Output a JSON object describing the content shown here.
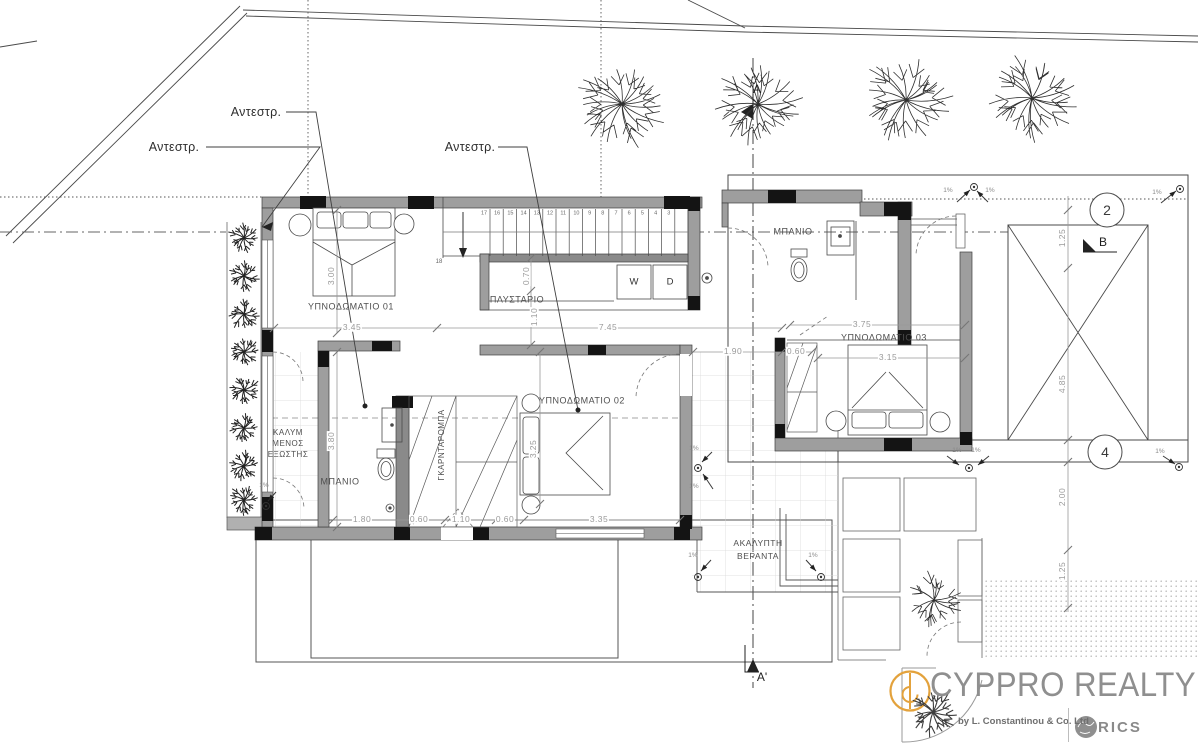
{
  "plan": {
    "rooms": {
      "bedroom01": "ΥΠΝΟΔΩΜΑΤΙΟ 01",
      "bedroom02": "ΥΠΝΟΔΩΜΑΤΙΟ 02",
      "bedroom03": "ΥΠΝΟΔΩΜΑΤΙΟ 03",
      "laundry": "ΠΛΥΣΤΑΡΙΟ",
      "bath_top": "ΜΠΑΝΙΟ",
      "bath_left": "ΜΠΑΝΙΟ",
      "wardrobe": "ΓΚΑΡΝΤΑΡΟΜΠΑ",
      "covered_balcony_lines": [
        "ΚΑΛΥΜ",
        "ΜΕΝΟΣ",
        "ΕΞΩΣΤΗΣ"
      ],
      "veranda_lines": [
        "ΑΚΑΛΥΠΤΗ",
        "ΒΕΡΑΝΤΑ"
      ]
    },
    "annotations": {
      "inverted": "Αντεστρ.",
      "slope": "1%",
      "riser18": "18",
      "washer": "W",
      "dryer": "D"
    },
    "markers": {
      "section_a": "A",
      "section_a_prime": "A'",
      "section_b": "B",
      "grid_2": "2",
      "grid_4": "4"
    },
    "stairs": {
      "numbers": [
        "17",
        "16",
        "15",
        "14",
        "13",
        "12",
        "11",
        "10",
        "9",
        "8",
        "7",
        "6",
        "5",
        "4",
        "3"
      ]
    },
    "dimensions": [
      {
        "t": "3.00",
        "x": 331,
        "y": 276,
        "rot": true
      },
      {
        "t": "3.45",
        "x": 352,
        "y": 327
      },
      {
        "t": "7.45",
        "x": 608,
        "y": 327
      },
      {
        "t": "3.75",
        "x": 862,
        "y": 324
      },
      {
        "t": "1.90",
        "x": 733,
        "y": 351
      },
      {
        "t": "0.60",
        "x": 796,
        "y": 351
      },
      {
        "t": "3.15",
        "x": 888,
        "y": 357
      },
      {
        "t": "0.70",
        "x": 526,
        "y": 276,
        "rot": true
      },
      {
        "t": "1.10",
        "x": 534,
        "y": 317,
        "rot": true
      },
      {
        "t": "3.80",
        "x": 331,
        "y": 441,
        "rot": true
      },
      {
        "t": "3.25",
        "x": 533,
        "y": 449,
        "rot": true
      },
      {
        "t": "1.80",
        "x": 362,
        "y": 519
      },
      {
        "t": "0.60",
        "x": 419,
        "y": 519
      },
      {
        "t": "1.10",
        "x": 461,
        "y": 519
      },
      {
        "t": "0.60",
        "x": 505,
        "y": 519
      },
      {
        "t": "3.35",
        "x": 599,
        "y": 519
      },
      {
        "t": "1.25",
        "x": 1062,
        "y": 238,
        "rot": true
      },
      {
        "t": "4.85",
        "x": 1062,
        "y": 384,
        "rot": true
      },
      {
        "t": "2.00",
        "x": 1062,
        "y": 497,
        "rot": true
      },
      {
        "t": "1.25",
        "x": 1062,
        "y": 571,
        "rot": true
      }
    ]
  },
  "logo": {
    "brand": "CYPPRO REALTY",
    "byline": "by L. Constantinou & Co. Ltd",
    "rics": "RICS"
  },
  "colors": {
    "wall": "#9e9e9e",
    "line": "#3a3a3a",
    "dim": "#9a9a9a",
    "accent_orange": "#E3A23C",
    "logo_gray": "#8f8f8f"
  }
}
